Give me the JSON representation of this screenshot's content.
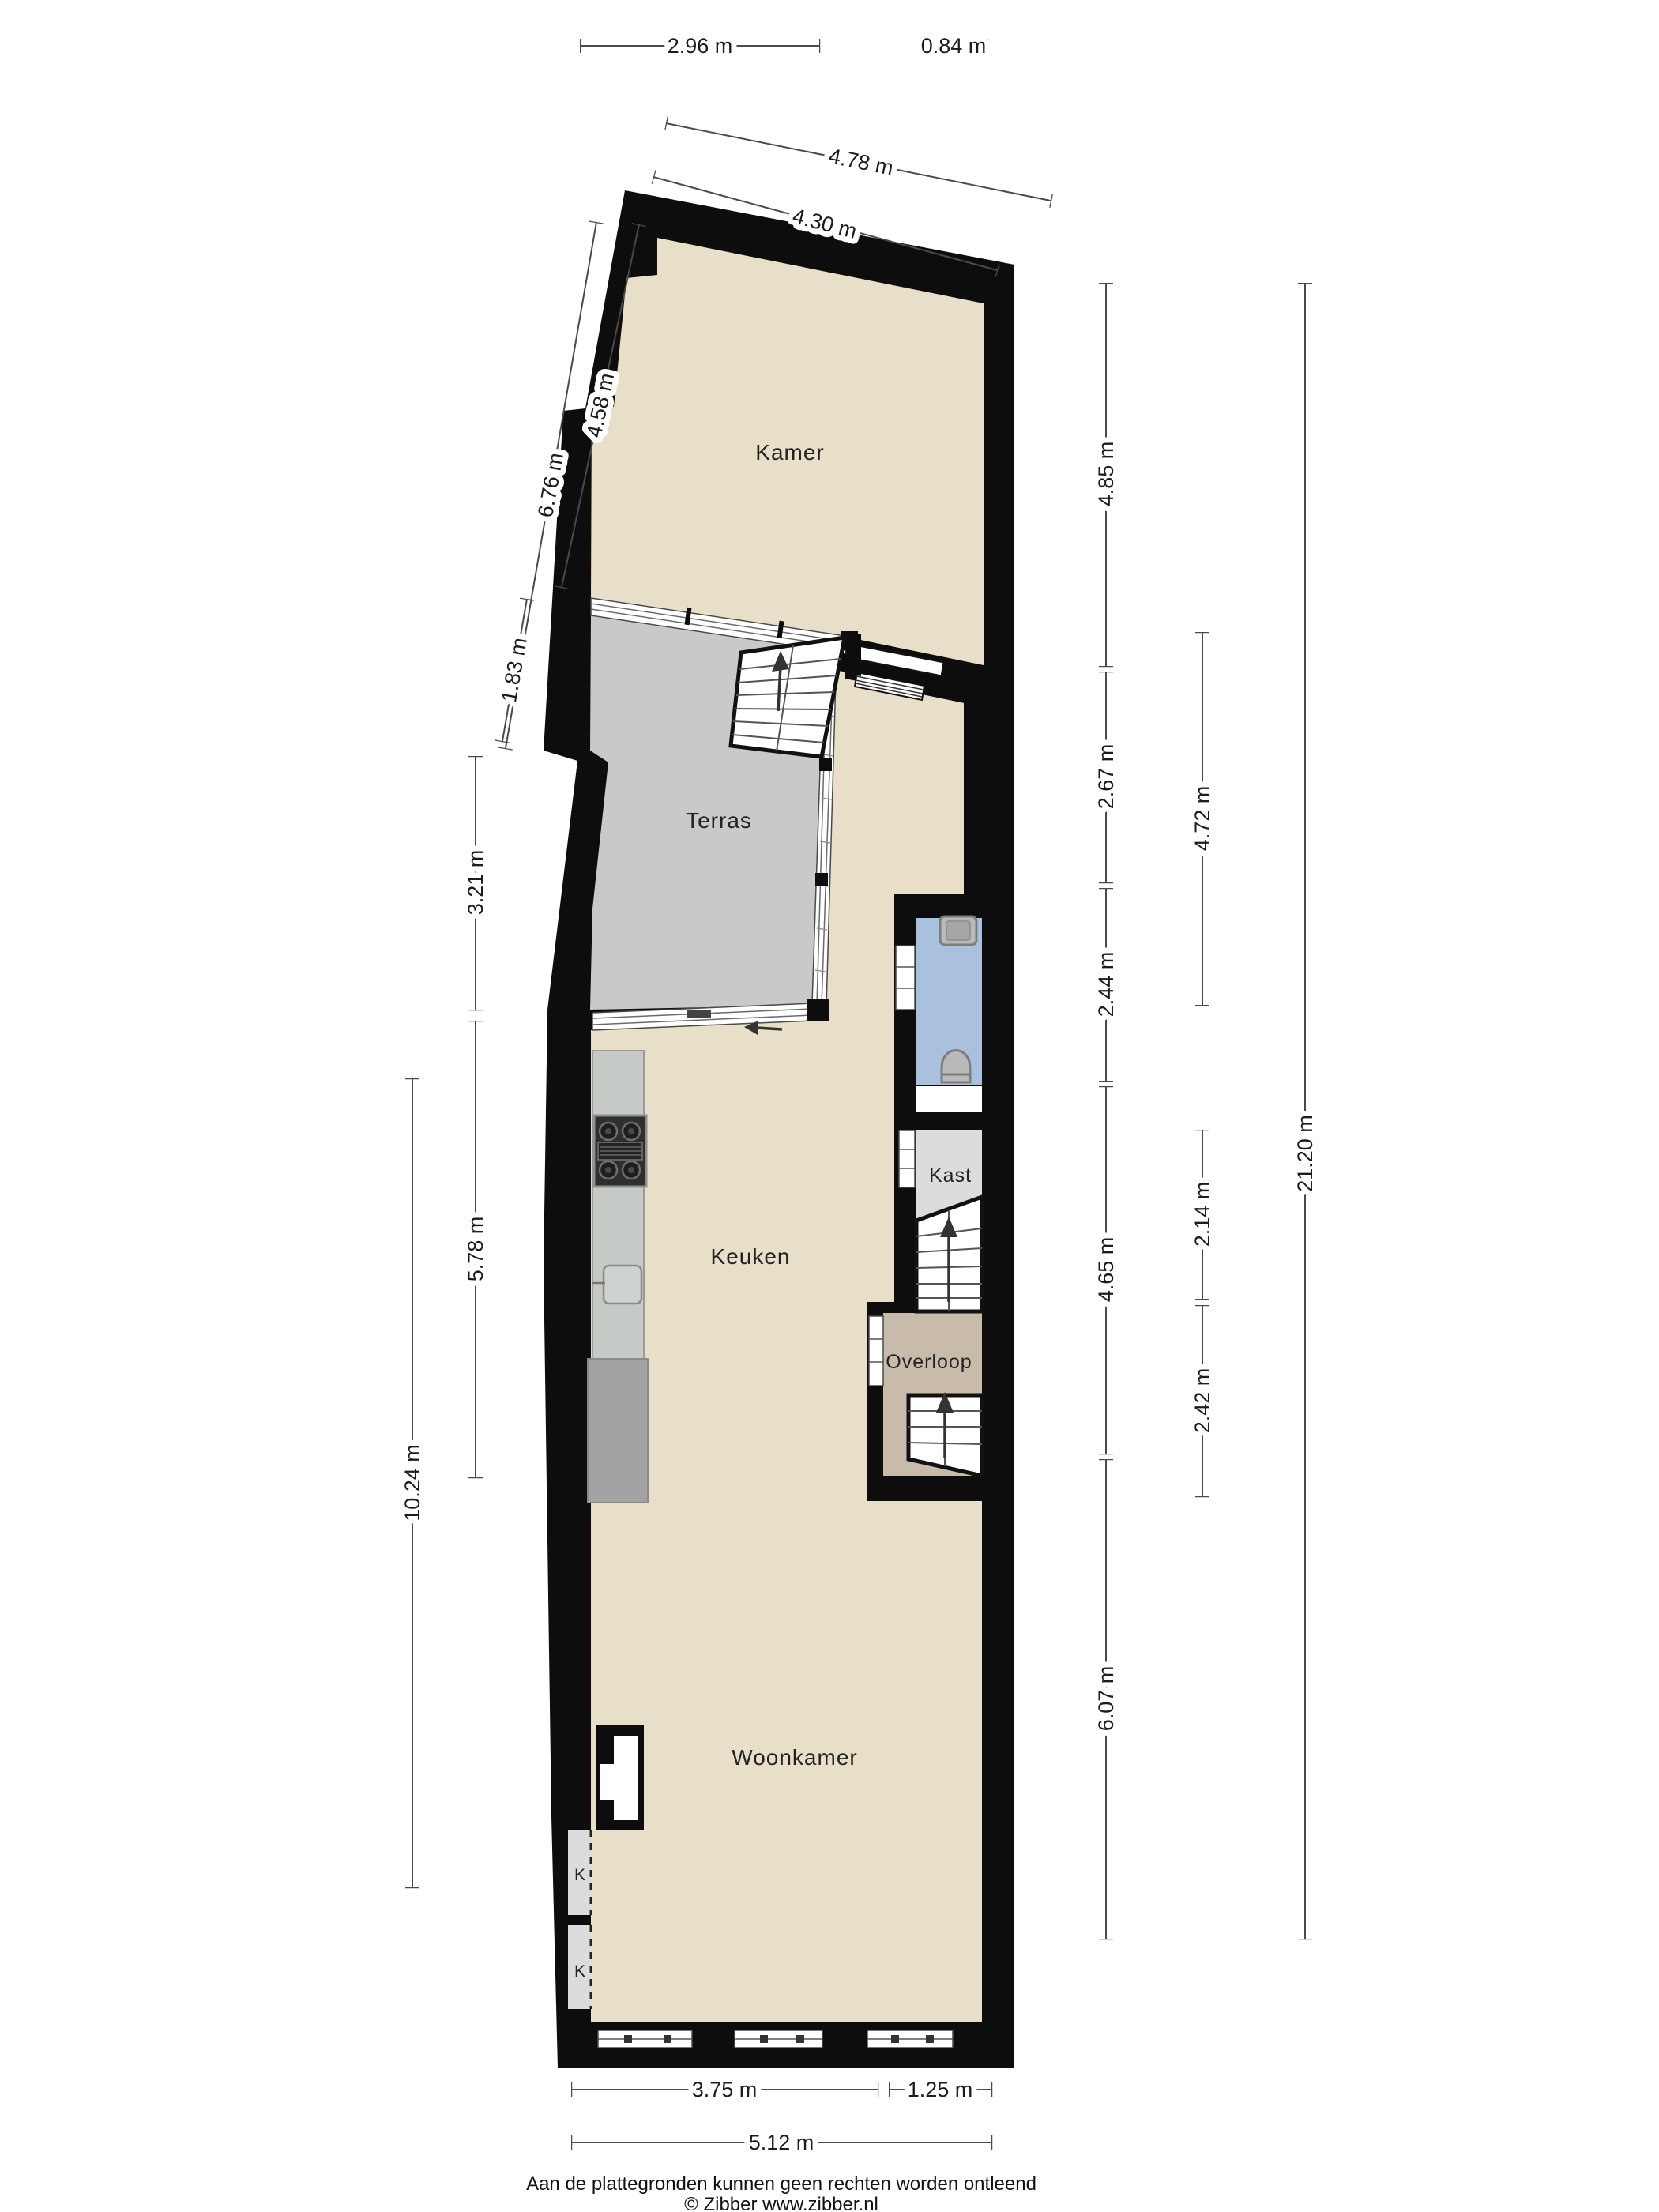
{
  "rooms": {
    "kamer": "Kamer",
    "terras": "Terras",
    "keuken": "Keuken",
    "woonkamer": "Woonkamer",
    "kast": "Kast",
    "overloop": "Overloop",
    "closet1": "K",
    "closet2": "K"
  },
  "dimensions": {
    "top": {
      "d296": "2.96 m",
      "d084": "0.84 m",
      "d478": "4.78 m",
      "d430": "4.30 m"
    },
    "left": {
      "d676": "6.76 m",
      "d458": "4.58 m",
      "d183": "1.83 m",
      "d321": "3.21 m",
      "d578": "5.78 m",
      "d1024": "10.24 m"
    },
    "right": {
      "d485": "4.85 m",
      "d267": "2.67 m",
      "d244": "2.44 m",
      "d465": "4.65 m",
      "d607": "6.07 m",
      "d472": "4.72 m",
      "d214": "2.14 m",
      "d242": "2.42 m",
      "d2120": "21.20 m"
    },
    "bottom": {
      "d375": "3.75 m",
      "d125": "1.25 m",
      "d512": "5.12 m"
    }
  },
  "footer": {
    "disclaimer": "Aan de plattegronden kunnen geen rechten worden ontleend",
    "copyright": "© Zibber www.zibber.nl"
  },
  "colors": {
    "wall": "#0d0d0d",
    "room_floor": "#e7dfc8",
    "terrace_floor": "#c9c9c9",
    "bathroom_floor": "#a9c1dc",
    "landing_floor": "#c9bbaa",
    "closet_floor": "#dcdcdc",
    "kast_floor": "#dcdcdc",
    "counter_light": "#c6cac6",
    "counter_dark": "#a3a3a3"
  }
}
